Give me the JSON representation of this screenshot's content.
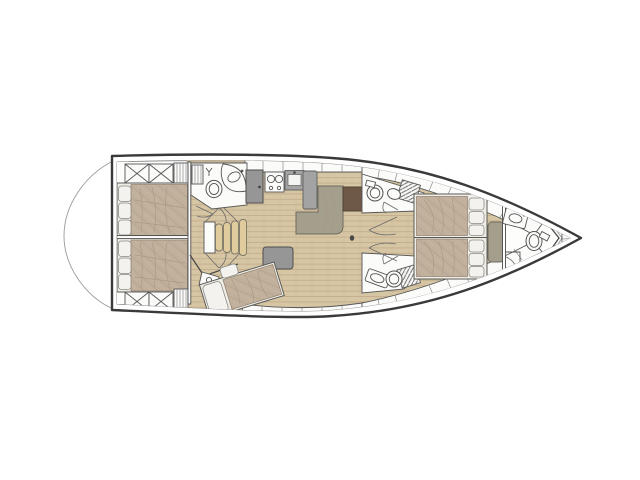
{
  "figure": {
    "type": "yacht-interior-floorplan",
    "orientation": "bow-right-stern-left",
    "visible_text": [],
    "areas": [
      "aft-cabin-port",
      "aft-cabin-starboard",
      "aft-head",
      "companionway-stairs",
      "third-cabin",
      "galley",
      "salon-sofa",
      "chart-table",
      "dinette-with-table",
      "mid-head-starboard",
      "mid-head-port",
      "corridor",
      "forward-master-cabin",
      "forward-head",
      "anchor-locker"
    ],
    "fixtures": [
      "toilet-icon",
      "sink-icon",
      "stove-icon",
      "fridge-icon",
      "shower-hatch-icon",
      "door-swing-icon",
      "mast-step-icon",
      "bow-fitting-icon"
    ]
  },
  "palette": {
    "background": "#ffffff",
    "hull_line": "#3a3a3a",
    "inner_line": "#8f8f8f",
    "wall_line": "#4a4a4a",
    "floor_wood": "#d7c6a4",
    "floor_plank_line": "#bfa989",
    "berth_duvet": "#c1b09c",
    "berth_fold": "#a8977f",
    "mattress": "#f0ede7",
    "pillow": "#f4f2ee",
    "sofa": "#a49e8d",
    "sofa_edge": "#6f6b5e",
    "table_wood": "#dec28e",
    "table_edge": "#8c6f49",
    "counter_gray": "#a3a3a3",
    "cabinet_gray": "#969696",
    "chart_table_brown": "#6e5949",
    "step_wood": "#e0cb9d",
    "fixture_fill": "#fbfbfa",
    "fixture_line": "#555555",
    "hatch_line": "#6f6f6f"
  }
}
